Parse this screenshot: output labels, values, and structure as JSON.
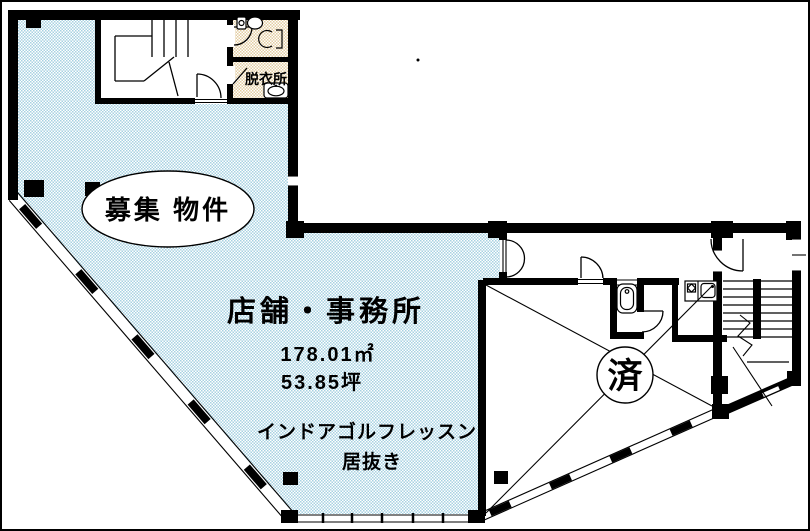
{
  "floor_plan": {
    "vacancy_badge": "募集 物件",
    "unit_type": "店舗・事務所",
    "area_sqm": "178.01㎡",
    "area_tsubo": "53.85坪",
    "previous_use": "インドアゴルフレッスン",
    "condition": "居抜き",
    "occupied_mark": "済",
    "dressing_room_label": "脱衣所",
    "colors": {
      "vacant_fill": "#a7d2e2",
      "wet_area_fill": "#e3cda2",
      "wall": "#000000",
      "background": "#ffffff"
    }
  }
}
